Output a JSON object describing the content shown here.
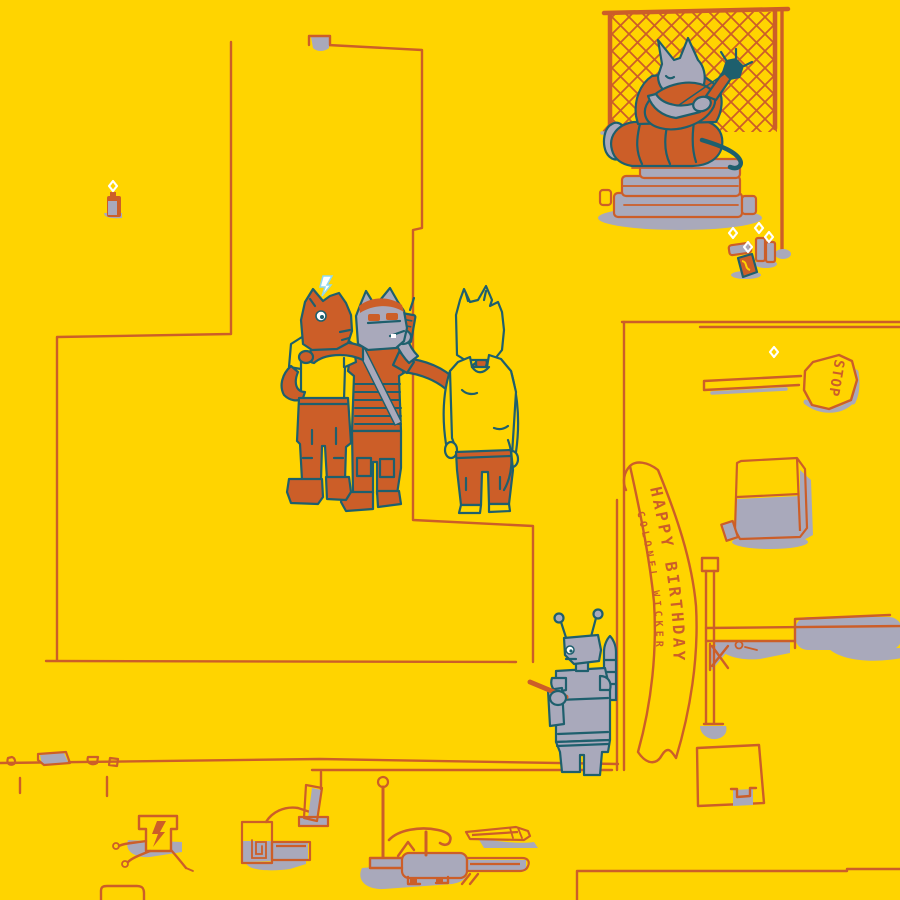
{
  "colors": {
    "background": "#FFD400",
    "line": "#CC5E28",
    "outline": "#1E5F6D",
    "gray": "#A9A9BB",
    "white": "#FFFFFF",
    "spark": "#8FD8EE"
  },
  "banner": {
    "line1": "HAPPY BIRTHDAY",
    "line2": "COLONEL WICKER"
  },
  "stop_sign": {
    "label": "STOP"
  }
}
